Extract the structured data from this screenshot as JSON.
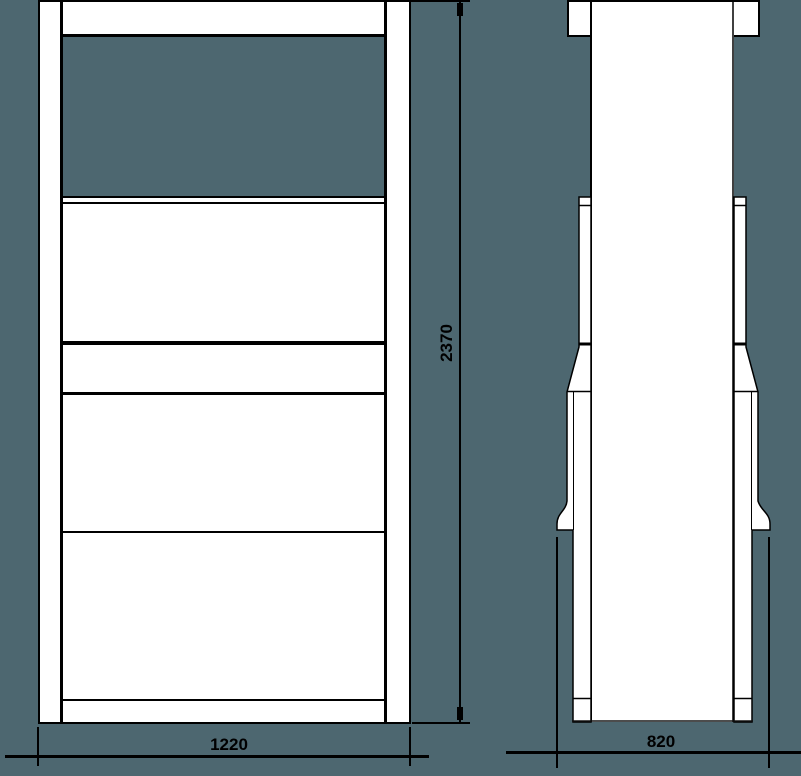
{
  "colors": {
    "background": "#4d6770",
    "shape_fill": "#ffffff",
    "line": "#000000"
  },
  "dimensions": {
    "front_width": {
      "label": "1220"
    },
    "front_height": {
      "label": "2370"
    },
    "side_depth": {
      "label": "820"
    }
  }
}
